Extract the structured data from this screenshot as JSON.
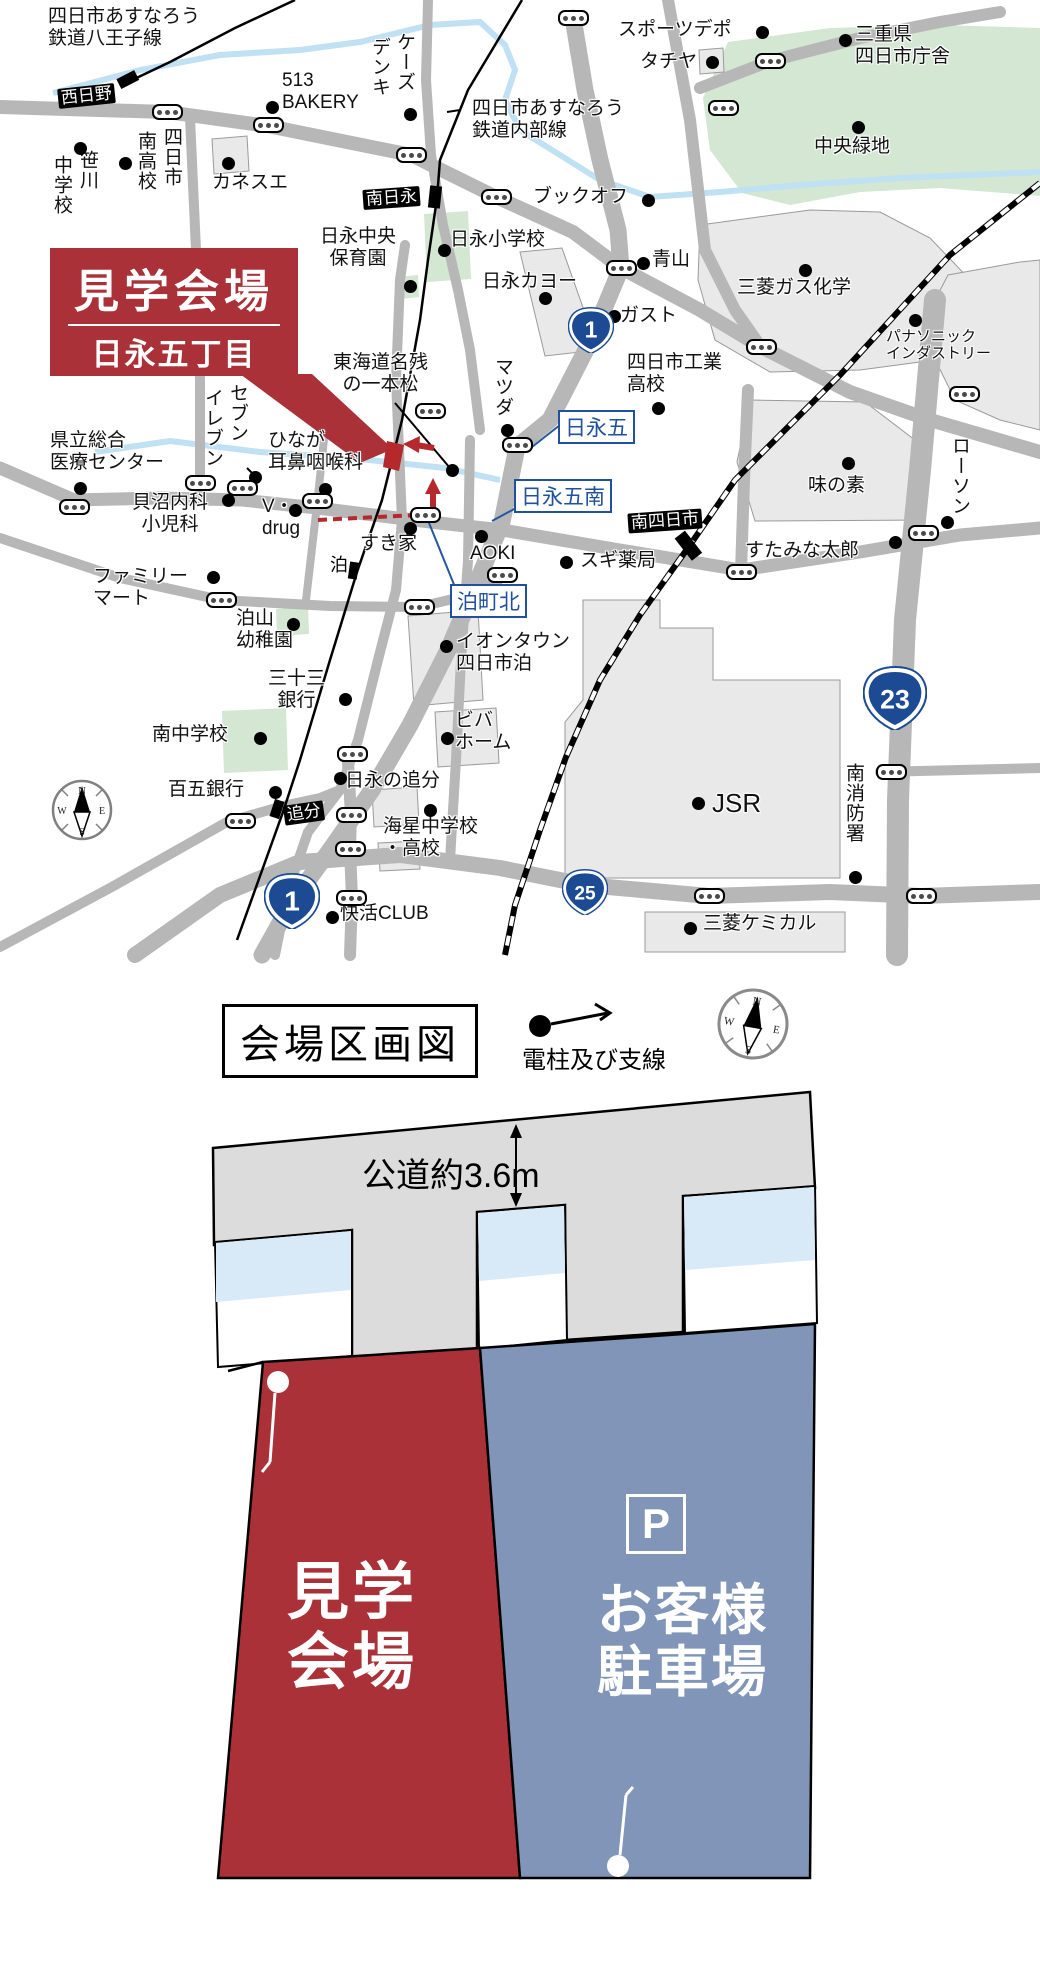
{
  "map": {
    "callout": {
      "title": "見学会場",
      "subtitle": "日永五丁目"
    },
    "labels": [
      {
        "t": "四日市あすなろう\n鉄道八王子線",
        "x": 48,
        "y": 6
      },
      {
        "t": "513\nBAKERY",
        "x": 282,
        "y": 70
      },
      {
        "t": "カネスエ",
        "x": 212,
        "y": 172
      },
      {
        "t": "笹川",
        "x": 76,
        "y": 150,
        "v": true
      },
      {
        "t": "中学校",
        "x": 50,
        "y": 155,
        "v": true
      },
      {
        "t": "四日市",
        "x": 160,
        "y": 127,
        "v": true
      },
      {
        "t": "南高校",
        "x": 134,
        "y": 131,
        "v": true
      },
      {
        "t": "ケーズ",
        "x": 393,
        "y": 32,
        "v": true
      },
      {
        "t": "デンキ",
        "x": 368,
        "y": 37,
        "v": true
      },
      {
        "t": "四日市あすなろう\n鉄道内部線",
        "x": 472,
        "y": 98
      },
      {
        "t": "ブックオフ",
        "x": 533,
        "y": 186
      },
      {
        "t": "スポーツデポ",
        "x": 618,
        "y": 19
      },
      {
        "t": "タチヤ",
        "x": 640,
        "y": 51
      },
      {
        "t": "三重県\n四日市庁舎",
        "x": 855,
        "y": 24
      },
      {
        "t": "中央緑地",
        "x": 814,
        "y": 136
      },
      {
        "t": "日永中央\n保育園",
        "x": 320,
        "y": 226,
        "c": true
      },
      {
        "t": "日永小学校",
        "x": 450,
        "y": 229
      },
      {
        "t": "日永カヨー",
        "x": 482,
        "y": 271
      },
      {
        "t": "青山",
        "x": 652,
        "y": 249
      },
      {
        "t": "ガスト",
        "x": 620,
        "y": 305
      },
      {
        "t": "三菱ガス化学",
        "x": 737,
        "y": 277
      },
      {
        "t": "パナソニック\nインダストリー",
        "x": 886,
        "y": 328,
        "s": 15
      },
      {
        "t": "四日市工業\n高校",
        "x": 627,
        "y": 352
      },
      {
        "t": "東海道名残\nの一本松",
        "x": 333,
        "y": 352,
        "c": true
      },
      {
        "t": "マツダ",
        "x": 491,
        "y": 357,
        "v": true
      },
      {
        "t": "味の素",
        "x": 808,
        "y": 475
      },
      {
        "t": "ローソン",
        "x": 948,
        "y": 436,
        "v": true
      },
      {
        "t": "すたみな太郎",
        "x": 745,
        "y": 540
      },
      {
        "t": "スギ薬局",
        "x": 580,
        "y": 550
      },
      {
        "t": "AOKI",
        "x": 470,
        "y": 543
      },
      {
        "t": "すき家",
        "x": 360,
        "y": 533
      },
      {
        "t": "V・\ndrug",
        "x": 262,
        "y": 496
      },
      {
        "t": "貝沼内科\n小児科",
        "x": 132,
        "y": 492,
        "c": true
      },
      {
        "t": "県立総合\n医療センター",
        "x": 50,
        "y": 430
      },
      {
        "t": "セブン",
        "x": 226,
        "y": 383,
        "v": true
      },
      {
        "t": "イレブン",
        "x": 201,
        "y": 388,
        "v": true
      },
      {
        "t": "ひなが\n耳鼻咽喉科",
        "x": 268,
        "y": 430
      },
      {
        "t": "ファミリー\nマート",
        "x": 93,
        "y": 566
      },
      {
        "t": "泊山\n幼稚園",
        "x": 236,
        "y": 608
      },
      {
        "t": "三十三\n銀行",
        "x": 268,
        "y": 668,
        "c": true
      },
      {
        "t": "南中学校",
        "x": 152,
        "y": 724
      },
      {
        "t": "イオンタウン\n四日市泊",
        "x": 456,
        "y": 631
      },
      {
        "t": "ビバ\nホーム",
        "x": 455,
        "y": 710
      },
      {
        "t": "百五銀行",
        "x": 168,
        "y": 779
      },
      {
        "t": "日永の追分",
        "x": 345,
        "y": 770
      },
      {
        "t": "海星中学校\n・高校",
        "x": 383,
        "y": 816
      },
      {
        "t": "快活CLUB",
        "x": 340,
        "y": 903
      },
      {
        "t": "JSR",
        "x": 712,
        "y": 788,
        "s": 26
      },
      {
        "t": "南消防署",
        "x": 842,
        "y": 763,
        "v": true
      },
      {
        "t": "三菱ケミカル",
        "x": 703,
        "y": 913
      }
    ],
    "stations": [
      {
        "t": "西日野",
        "x": 58,
        "y": 86,
        "r": -6
      },
      {
        "t": "南日永",
        "x": 363,
        "y": 188,
        "r": -4
      },
      {
        "t": "追分",
        "x": 284,
        "y": 803,
        "r": -8
      },
      {
        "t": "南四日市",
        "x": 628,
        "y": 511,
        "r": -4
      }
    ],
    "stations_plain": [
      {
        "t": "泊",
        "x": 325,
        "y": 555
      }
    ],
    "intersections": [
      {
        "t": "日永五",
        "x": 558,
        "y": 410
      },
      {
        "t": "日永五南",
        "x": 514,
        "y": 479
      },
      {
        "t": "泊町北",
        "x": 450,
        "y": 584
      }
    ],
    "shields": [
      {
        "n": "1",
        "x": 591,
        "y": 330,
        "s": 46
      },
      {
        "n": "23",
        "x": 895,
        "y": 698,
        "s": 64
      },
      {
        "n": "25",
        "x": 585,
        "y": 892,
        "s": 46
      },
      {
        "n": "1",
        "x": 292,
        "y": 901,
        "s": 56
      }
    ],
    "signals": [
      [
        167,
        112
      ],
      [
        268,
        125
      ],
      [
        411,
        155
      ],
      [
        573,
        18
      ],
      [
        770,
        61
      ],
      [
        723,
        108
      ],
      [
        496,
        197
      ],
      [
        621,
        268
      ],
      [
        761,
        347
      ],
      [
        964,
        394
      ],
      [
        430,
        411
      ],
      [
        517,
        445
      ],
      [
        74,
        507
      ],
      [
        200,
        483
      ],
      [
        242,
        488
      ],
      [
        317,
        501
      ],
      [
        221,
        600
      ],
      [
        419,
        607
      ],
      [
        425,
        515
      ],
      [
        502,
        575
      ],
      [
        923,
        533
      ],
      [
        741,
        572
      ],
      [
        352,
        754
      ],
      [
        240,
        821
      ],
      [
        351,
        815
      ],
      [
        350,
        849
      ],
      [
        351,
        898
      ],
      [
        709,
        896
      ],
      [
        921,
        896
      ],
      [
        891,
        772
      ]
    ],
    "dots": [
      [
        272,
        107
      ],
      [
        80,
        148
      ],
      [
        125,
        163
      ],
      [
        228,
        163
      ],
      [
        410,
        114
      ],
      [
        762,
        32
      ],
      [
        712,
        62
      ],
      [
        845,
        40
      ],
      [
        858,
        127
      ],
      [
        648,
        200
      ],
      [
        444,
        250
      ],
      [
        410,
        286
      ],
      [
        545,
        298
      ],
      [
        643,
        263
      ],
      [
        614,
        316
      ],
      [
        805,
        270
      ],
      [
        915,
        320
      ],
      [
        658,
        408
      ],
      [
        80,
        488
      ],
      [
        255,
        477
      ],
      [
        325,
        489
      ],
      [
        228,
        500
      ],
      [
        295,
        510
      ],
      [
        452,
        470
      ],
      [
        507,
        430
      ],
      [
        410,
        528
      ],
      [
        481,
        536
      ],
      [
        566,
        562
      ],
      [
        213,
        577
      ],
      [
        293,
        624
      ],
      [
        345,
        699
      ],
      [
        260,
        738
      ],
      [
        446,
        646
      ],
      [
        447,
        738
      ],
      [
        895,
        542
      ],
      [
        947,
        522
      ],
      [
        848,
        463
      ],
      [
        698,
        803
      ],
      [
        855,
        877
      ],
      [
        690,
        928
      ],
      [
        275,
        792
      ],
      [
        340,
        778
      ],
      [
        430,
        810
      ],
      [
        332,
        917
      ]
    ],
    "compass": {
      "letters": [
        "N",
        "E",
        "S",
        "W"
      ]
    }
  },
  "site_plan": {
    "title": "会場区画図",
    "legend_label": "電柱及び支線",
    "road_label": "公道約3.6m",
    "venue_label": "見学\n会場",
    "parking_icon": "P",
    "parking_label": "お客様\n駐車場",
    "colors": {
      "venue": "#a93137",
      "parking": "#8095b8"
    }
  }
}
